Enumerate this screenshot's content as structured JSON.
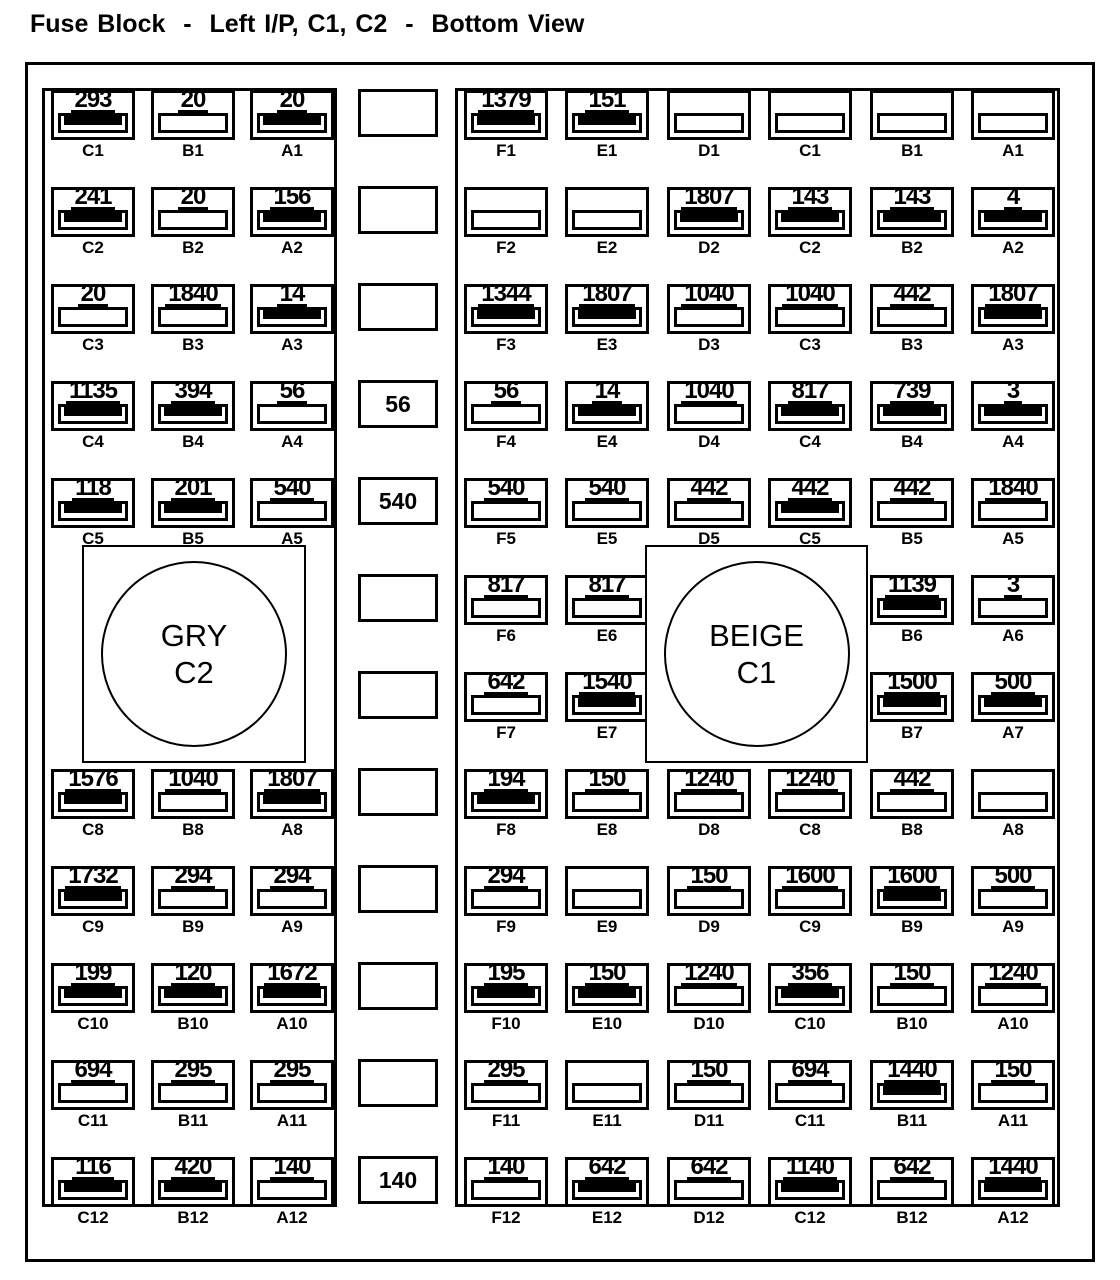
{
  "title": "Fuse Block  -  Left I/P, C1, C2  -  Bottom View",
  "colors": {
    "ink": "#000000",
    "background": "#ffffff"
  },
  "connectors": {
    "left": {
      "name": "GRY",
      "code": "C2"
    },
    "right": {
      "name": "BEIGE",
      "code": "C1"
    }
  },
  "middle_column": {
    "rows": [
      "",
      "",
      "",
      "56",
      "540",
      "",
      "",
      "",
      "",
      "",
      "",
      "140"
    ]
  },
  "left_section": {
    "columns": [
      "C",
      "B",
      "A"
    ],
    "rows": [
      {
        "cells": [
          {
            "col": "C",
            "pin": "C1",
            "circuit": "293",
            "filled": true
          },
          {
            "col": "B",
            "pin": "B1",
            "circuit": "20",
            "filled": false
          },
          {
            "col": "A",
            "pin": "A1",
            "circuit": "20",
            "filled": true
          }
        ]
      },
      {
        "cells": [
          {
            "col": "C",
            "pin": "C2",
            "circuit": "241",
            "filled": true
          },
          {
            "col": "B",
            "pin": "B2",
            "circuit": "20",
            "filled": false
          },
          {
            "col": "A",
            "pin": "A2",
            "circuit": "156",
            "filled": true
          }
        ]
      },
      {
        "cells": [
          {
            "col": "C",
            "pin": "C3",
            "circuit": "20",
            "filled": false
          },
          {
            "col": "B",
            "pin": "B3",
            "circuit": "1840",
            "filled": false
          },
          {
            "col": "A",
            "pin": "A3",
            "circuit": "14",
            "filled": true
          }
        ]
      },
      {
        "cells": [
          {
            "col": "C",
            "pin": "C4",
            "circuit": "1135",
            "filled": true
          },
          {
            "col": "B",
            "pin": "B4",
            "circuit": "394",
            "filled": true
          },
          {
            "col": "A",
            "pin": "A4",
            "circuit": "56",
            "filled": false
          }
        ]
      },
      {
        "cells": [
          {
            "col": "C",
            "pin": "C5",
            "circuit": "118",
            "filled": true
          },
          {
            "col": "B",
            "pin": "B5",
            "circuit": "201",
            "filled": true
          },
          {
            "col": "A",
            "pin": "A5",
            "circuit": "540",
            "filled": false
          }
        ]
      },
      {
        "cells": []
      },
      {
        "cells": []
      },
      {
        "cells": [
          {
            "col": "C",
            "pin": "C8",
            "circuit": "1576",
            "filled": true
          },
          {
            "col": "B",
            "pin": "B8",
            "circuit": "1040",
            "filled": false
          },
          {
            "col": "A",
            "pin": "A8",
            "circuit": "1807",
            "filled": true
          }
        ]
      },
      {
        "cells": [
          {
            "col": "C",
            "pin": "C9",
            "circuit": "1732",
            "filled": true
          },
          {
            "col": "B",
            "pin": "B9",
            "circuit": "294",
            "filled": false
          },
          {
            "col": "A",
            "pin": "A9",
            "circuit": "294",
            "filled": false
          }
        ]
      },
      {
        "cells": [
          {
            "col": "C",
            "pin": "C10",
            "circuit": "199",
            "filled": true
          },
          {
            "col": "B",
            "pin": "B10",
            "circuit": "120",
            "filled": true
          },
          {
            "col": "A",
            "pin": "A10",
            "circuit": "1672",
            "filled": true
          }
        ]
      },
      {
        "cells": [
          {
            "col": "C",
            "pin": "C11",
            "circuit": "694",
            "filled": false
          },
          {
            "col": "B",
            "pin": "B11",
            "circuit": "295",
            "filled": false
          },
          {
            "col": "A",
            "pin": "A11",
            "circuit": "295",
            "filled": false
          }
        ]
      },
      {
        "cells": [
          {
            "col": "C",
            "pin": "C12",
            "circuit": "116",
            "filled": true
          },
          {
            "col": "B",
            "pin": "B12",
            "circuit": "420",
            "filled": true
          },
          {
            "col": "A",
            "pin": "A12",
            "circuit": "140",
            "filled": false
          }
        ]
      }
    ]
  },
  "right_section": {
    "columns": [
      "F",
      "E",
      "D",
      "C",
      "B",
      "A"
    ],
    "rows": [
      {
        "cells": [
          {
            "col": "F",
            "pin": "F1",
            "circuit": "1379",
            "filled": true
          },
          {
            "col": "E",
            "pin": "E1",
            "circuit": "151",
            "filled": true
          },
          {
            "col": "D",
            "pin": "D1",
            "circuit": "",
            "filled": false
          },
          {
            "col": "C",
            "pin": "C1",
            "circuit": "",
            "filled": false
          },
          {
            "col": "B",
            "pin": "B1",
            "circuit": "",
            "filled": false
          },
          {
            "col": "A",
            "pin": "A1",
            "circuit": "",
            "filled": false
          }
        ]
      },
      {
        "cells": [
          {
            "col": "F",
            "pin": "F2",
            "circuit": "",
            "filled": false
          },
          {
            "col": "E",
            "pin": "E2",
            "circuit": "",
            "filled": false
          },
          {
            "col": "D",
            "pin": "D2",
            "circuit": "1807",
            "filled": true
          },
          {
            "col": "C",
            "pin": "C2",
            "circuit": "143",
            "filled": true
          },
          {
            "col": "B",
            "pin": "B2",
            "circuit": "143",
            "filled": true
          },
          {
            "col": "A",
            "pin": "A2",
            "circuit": "4",
            "filled": true
          }
        ]
      },
      {
        "cells": [
          {
            "col": "F",
            "pin": "F3",
            "circuit": "1344",
            "filled": true
          },
          {
            "col": "E",
            "pin": "E3",
            "circuit": "1807",
            "filled": true
          },
          {
            "col": "D",
            "pin": "D3",
            "circuit": "1040",
            "filled": false
          },
          {
            "col": "C",
            "pin": "C3",
            "circuit": "1040",
            "filled": false
          },
          {
            "col": "B",
            "pin": "B3",
            "circuit": "442",
            "filled": false
          },
          {
            "col": "A",
            "pin": "A3",
            "circuit": "1807",
            "filled": true
          }
        ]
      },
      {
        "cells": [
          {
            "col": "F",
            "pin": "F4",
            "circuit": "56",
            "filled": false
          },
          {
            "col": "E",
            "pin": "E4",
            "circuit": "14",
            "filled": true
          },
          {
            "col": "D",
            "pin": "D4",
            "circuit": "1040",
            "filled": false
          },
          {
            "col": "C",
            "pin": "C4",
            "circuit": "817",
            "filled": true
          },
          {
            "col": "B",
            "pin": "B4",
            "circuit": "739",
            "filled": true
          },
          {
            "col": "A",
            "pin": "A4",
            "circuit": "3",
            "filled": true
          }
        ]
      },
      {
        "cells": [
          {
            "col": "F",
            "pin": "F5",
            "circuit": "540",
            "filled": false
          },
          {
            "col": "E",
            "pin": "E5",
            "circuit": "540",
            "filled": false
          },
          {
            "col": "D",
            "pin": "D5",
            "circuit": "442",
            "filled": false
          },
          {
            "col": "C",
            "pin": "C5",
            "circuit": "442",
            "filled": true
          },
          {
            "col": "B",
            "pin": "B5",
            "circuit": "442",
            "filled": false
          },
          {
            "col": "A",
            "pin": "A5",
            "circuit": "1840",
            "filled": false
          }
        ]
      },
      {
        "cells": [
          {
            "col": "F",
            "pin": "F6",
            "circuit": "817",
            "filled": false
          },
          {
            "col": "E",
            "pin": "E6",
            "circuit": "817",
            "filled": false
          },
          {
            "col": "B",
            "pin": "B6",
            "circuit": "1139",
            "filled": true
          },
          {
            "col": "A",
            "pin": "A6",
            "circuit": "3",
            "filled": false
          }
        ]
      },
      {
        "cells": [
          {
            "col": "F",
            "pin": "F7",
            "circuit": "642",
            "filled": false
          },
          {
            "col": "E",
            "pin": "E7",
            "circuit": "1540",
            "filled": true
          },
          {
            "col": "B",
            "pin": "B7",
            "circuit": "1500",
            "filled": true
          },
          {
            "col": "A",
            "pin": "A7",
            "circuit": "500",
            "filled": true
          }
        ]
      },
      {
        "cells": [
          {
            "col": "F",
            "pin": "F8",
            "circuit": "194",
            "filled": true
          },
          {
            "col": "E",
            "pin": "E8",
            "circuit": "150",
            "filled": false
          },
          {
            "col": "D",
            "pin": "D8",
            "circuit": "1240",
            "filled": false
          },
          {
            "col": "C",
            "pin": "C8",
            "circuit": "1240",
            "filled": false
          },
          {
            "col": "B",
            "pin": "B8",
            "circuit": "442",
            "filled": false
          },
          {
            "col": "A",
            "pin": "A8",
            "circuit": "",
            "filled": false
          }
        ]
      },
      {
        "cells": [
          {
            "col": "F",
            "pin": "F9",
            "circuit": "294",
            "filled": false
          },
          {
            "col": "E",
            "pin": "E9",
            "circuit": "",
            "filled": false
          },
          {
            "col": "D",
            "pin": "D9",
            "circuit": "150",
            "filled": false
          },
          {
            "col": "C",
            "pin": "C9",
            "circuit": "1600",
            "filled": false
          },
          {
            "col": "B",
            "pin": "B9",
            "circuit": "1600",
            "filled": true
          },
          {
            "col": "A",
            "pin": "A9",
            "circuit": "500",
            "filled": false
          }
        ]
      },
      {
        "cells": [
          {
            "col": "F",
            "pin": "F10",
            "circuit": "195",
            "filled": true
          },
          {
            "col": "E",
            "pin": "E10",
            "circuit": "150",
            "filled": true
          },
          {
            "col": "D",
            "pin": "D10",
            "circuit": "1240",
            "filled": false
          },
          {
            "col": "C",
            "pin": "C10",
            "circuit": "356",
            "filled": true
          },
          {
            "col": "B",
            "pin": "B10",
            "circuit": "150",
            "filled": false
          },
          {
            "col": "A",
            "pin": "A10",
            "circuit": "1240",
            "filled": false
          }
        ]
      },
      {
        "cells": [
          {
            "col": "F",
            "pin": "F11",
            "circuit": "295",
            "filled": false
          },
          {
            "col": "E",
            "pin": "E11",
            "circuit": "",
            "filled": false
          },
          {
            "col": "D",
            "pin": "D11",
            "circuit": "150",
            "filled": false
          },
          {
            "col": "C",
            "pin": "C11",
            "circuit": "694",
            "filled": false
          },
          {
            "col": "B",
            "pin": "B11",
            "circuit": "1440",
            "filled": true
          },
          {
            "col": "A",
            "pin": "A11",
            "circuit": "150",
            "filled": false
          }
        ]
      },
      {
        "cells": [
          {
            "col": "F",
            "pin": "F12",
            "circuit": "140",
            "filled": false
          },
          {
            "col": "E",
            "pin": "E12",
            "circuit": "642",
            "filled": true
          },
          {
            "col": "D",
            "pin": "D12",
            "circuit": "642",
            "filled": false
          },
          {
            "col": "C",
            "pin": "C12",
            "circuit": "1140",
            "filled": true
          },
          {
            "col": "B",
            "pin": "B12",
            "circuit": "642",
            "filled": false
          },
          {
            "col": "A",
            "pin": "A12",
            "circuit": "1440",
            "filled": true
          }
        ]
      }
    ]
  }
}
